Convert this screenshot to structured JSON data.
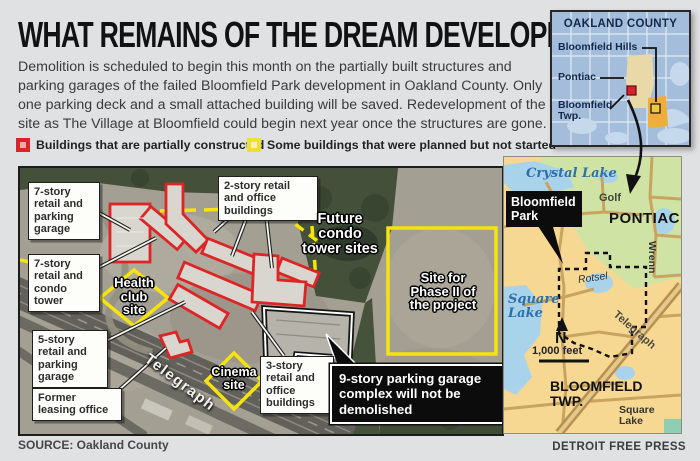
{
  "header": {
    "title": "WHAT REMAINS OF THE DREAM DEVELOPMENT",
    "intro": "Demolition is scheduled to begin this month on the partially built structures and parking garages of the failed Bloomfield Park development in Oakland County. Only one parking deck and a small attached building will be saved. Redevelopment of the site as The Village at Bloomfield could begin next year once the structures are gone."
  },
  "legend": {
    "items": [
      {
        "label": "Buildings that are partially constructed",
        "color": "#d9252a"
      },
      {
        "label": "Some buildings that were planned but not started",
        "color": "#efe02c"
      }
    ]
  },
  "inset_map": {
    "title": "OAKLAND COUNTY",
    "labels": {
      "bloomfield_hills": "Bloomfield Hills",
      "pontiac": "Pontiac",
      "bloomfield_twp": "Bloomfield Twp."
    }
  },
  "aerial": {
    "callouts": {
      "seven_story_parking": "7-story retail and parking garage",
      "seven_story_condo": "7-story retail and condo tower",
      "two_story_offices": "2-story retail and office buildings",
      "five_story_parking": "5-story retail and parking garage",
      "former_leasing": "Former leasing office",
      "three_story_offices": "3-story retail and office buildings"
    },
    "site_labels": {
      "health_club": "Health club site",
      "future_condo": "Future condo tower sites",
      "phase_two": "Site for Phase II of the project",
      "cinema": "Cinema site"
    },
    "highlight": "9-story parking garage complex will not be demolished",
    "road": "Telegraph"
  },
  "detail_map": {
    "crystal_lake": "Crystal Lake",
    "golf": "Golf",
    "pontiac": "PONTIAC",
    "bloomfield_park": "Bloomfield Park",
    "rotsel": "Rotsel",
    "wrenn": "Wrenn",
    "square_lake": "Square Lake",
    "north": "N",
    "scale": "1,000 feet",
    "bloomfield_twp": "BLOOMFIELD TWP.",
    "telegraph": "Telegraph",
    "square_lake_road": "Square Lake"
  },
  "footer": {
    "source": "SOURCE: Oakland County",
    "credit": "DETROIT FREE PRESS"
  }
}
